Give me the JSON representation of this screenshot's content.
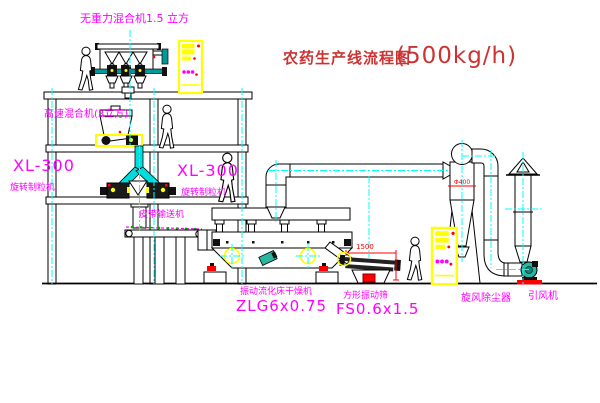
{
  "title": {
    "text": "农药生产线流程图",
    "capacity": "(500kg/h)"
  },
  "labels": {
    "gravity_mixer": "无重力混合机1.5 立方",
    "high_speed_mixer": "高速混合机(3立方)",
    "granulator_left_model": "XL-300",
    "granulator_left_name": "旋转制粒机",
    "granulator_right_model": "XL-300",
    "granulator_right_name": "旋转制粒机",
    "belt_conveyor": "皮带输送机",
    "fluid_bed_dryer_name": "振动流化床干燥机",
    "fluid_bed_dryer_model": "ZLG6x0.75",
    "vibrating_screen_name": "方形振动筛",
    "vibrating_screen_model": "FS0.6x1.5",
    "cyclone_dust_collector": "旋风除尘器",
    "induced_draft_fan": "引风机"
  },
  "dimensions": {
    "screen_length": "1500",
    "cyclone_diameter": "Φ400"
  },
  "colors": {
    "bg": "#ffffff",
    "label-magenta": "#ff00ff",
    "title-red": "#cc3333",
    "line-black": "#000000",
    "accent-yellow": "#ffff00",
    "pipe-cyan": "#00dddd",
    "centerline-cyan": "#00ffff",
    "dim-red": "#ff0000",
    "teal": "#009999",
    "fan-green": "#2ab5a0",
    "belt-green": "#00aa00"
  }
}
